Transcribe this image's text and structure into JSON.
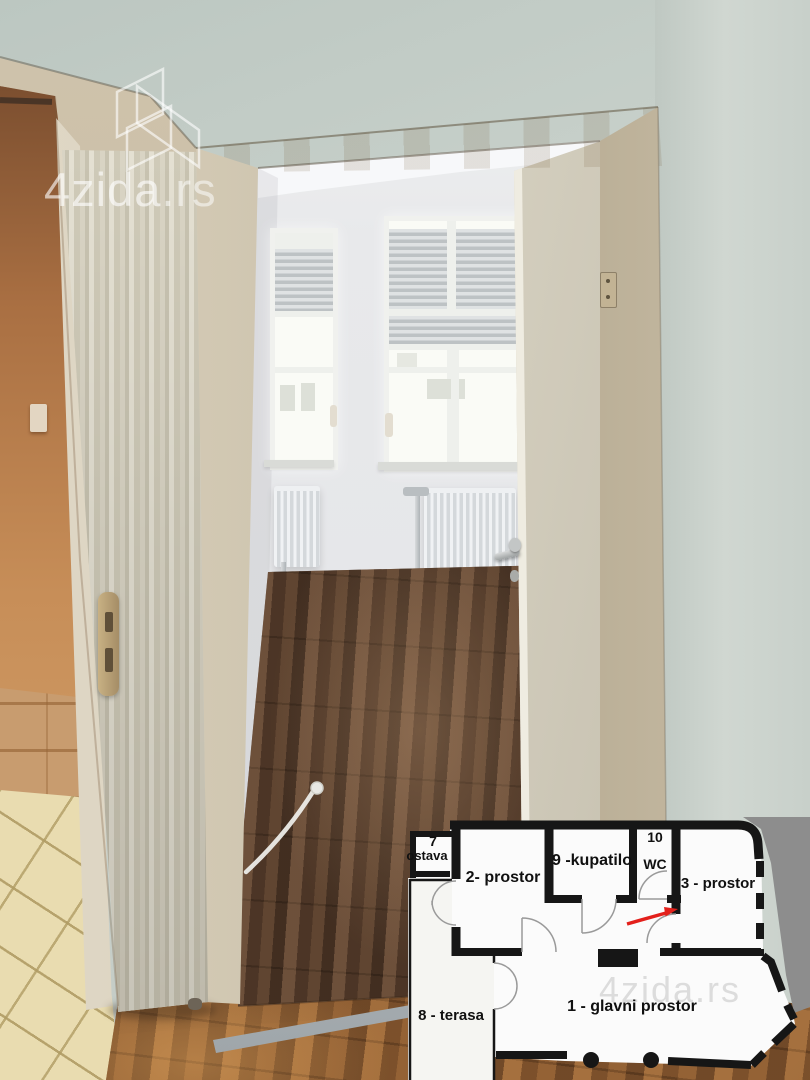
{
  "watermark": {
    "brand": "4zida",
    "tld": ".rs"
  },
  "floorplan": {
    "labels": {
      "storage_number": "7",
      "storage": "ostava",
      "room2": "2- prostor",
      "bathroom": "9 -kupatilo",
      "wc_number": "10",
      "wc": "WC",
      "room3": "3 - prostor",
      "terrace": "8 - terasa",
      "main_room": "1 - glavni prostor",
      "watermark": "4zida.rs"
    },
    "arrow_color": "#e3201b"
  },
  "palette": {
    "wall_sage": "#c7d0ca",
    "door_frame_beige": "#cdc2ab",
    "door_cream": "#ddd8ca",
    "interior_wall_white": "#e9eaec",
    "interior_floor_brown": "#523a2b",
    "foreground_floor_orange": "#8a5c33",
    "tile_floor_cream": "#e9dcb0",
    "tile_wall_tan": "#c89c6f",
    "plan_wall_black": "#161616",
    "plan_room_white": "#fbfbfb",
    "plan_outside_gray": "#8d8d8d",
    "arrow_red": "#e3201b",
    "watermark_white": "rgba(255,255,255,0.62)"
  },
  "scene": {
    "description": "Empty apartment: view through an open doorway into a room with two shuttered windows, radiators and dark laminate floor; folding door at left, tiled room at far left, floor-plan inset bottom right."
  }
}
